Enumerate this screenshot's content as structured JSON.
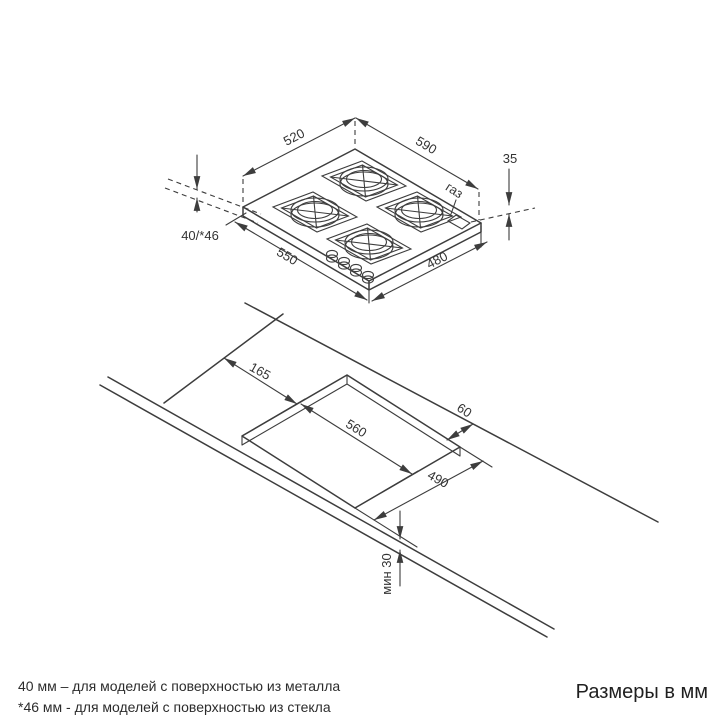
{
  "hob_view": {
    "back_left_edge": "520",
    "back_right_edge": "590",
    "gas_connection_height": "35",
    "gas_label": "газ",
    "height_above_counter": "40/*46",
    "front_left_edge": "550",
    "front_right_edge": "480"
  },
  "cutout_view": {
    "edge_to_cutout": "165",
    "cutout_width": "560",
    "cutout_depth": "490",
    "cutout_to_back_edge": "60",
    "min_front_distance": "мин 30"
  },
  "footnotes": {
    "metal": "40 мм – для моделей с поверхностью  из металла",
    "glass": "*46 мм - для моделей с поверхностью  из стекла"
  },
  "units_label": "Размеры в мм"
}
